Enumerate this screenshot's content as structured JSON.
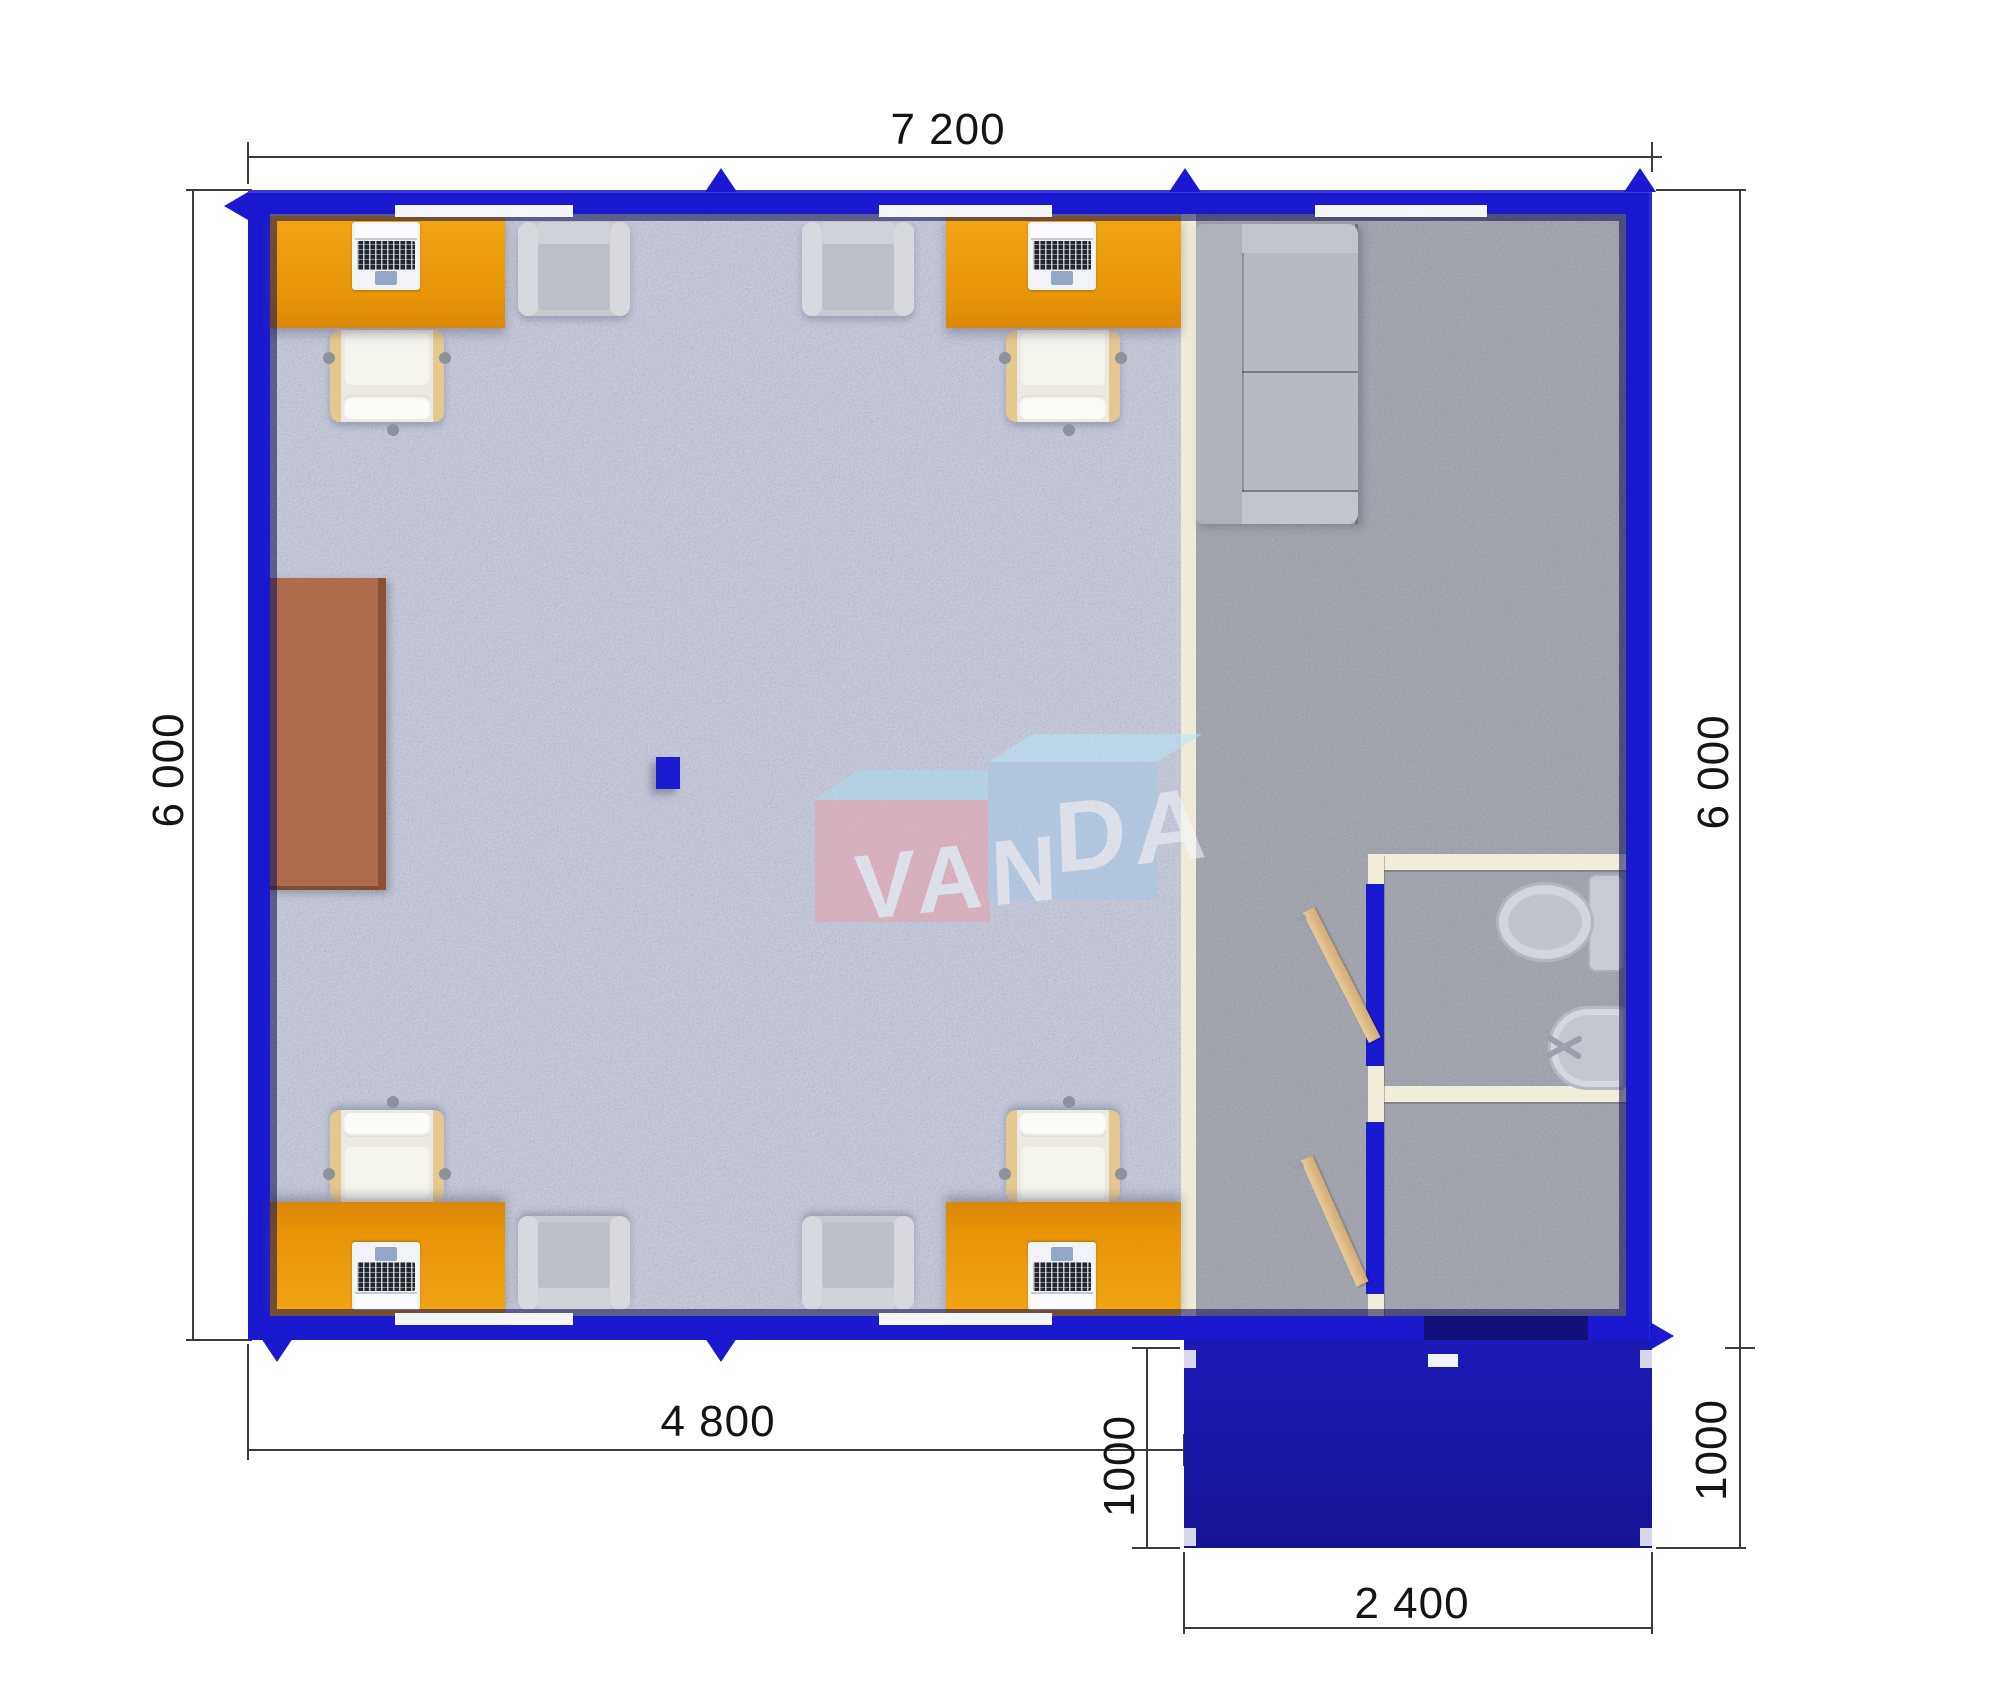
{
  "dimensions": {
    "top": "7 200",
    "left": "6 000",
    "right": "6 000",
    "bottom_left": "4 800",
    "porch_left": "1000",
    "porch_right": "1000",
    "porch_bottom": "2 400"
  },
  "watermark": {
    "left": "VAN",
    "right": "DA"
  },
  "colors": {
    "wall_blue": "#1b19d0",
    "porch_blue": "#1a17a4",
    "office_floor": "#c7cbda",
    "hall_floor": "#a6a8b2",
    "desk_orange": "#e89508",
    "meeting_table_brown": "#ae6c4c",
    "partition_cream": "#f0ebd8",
    "wood_door": "#d9b47e",
    "logo_pink": "#e8a0aa",
    "logo_blue": "#a6c8e6"
  }
}
